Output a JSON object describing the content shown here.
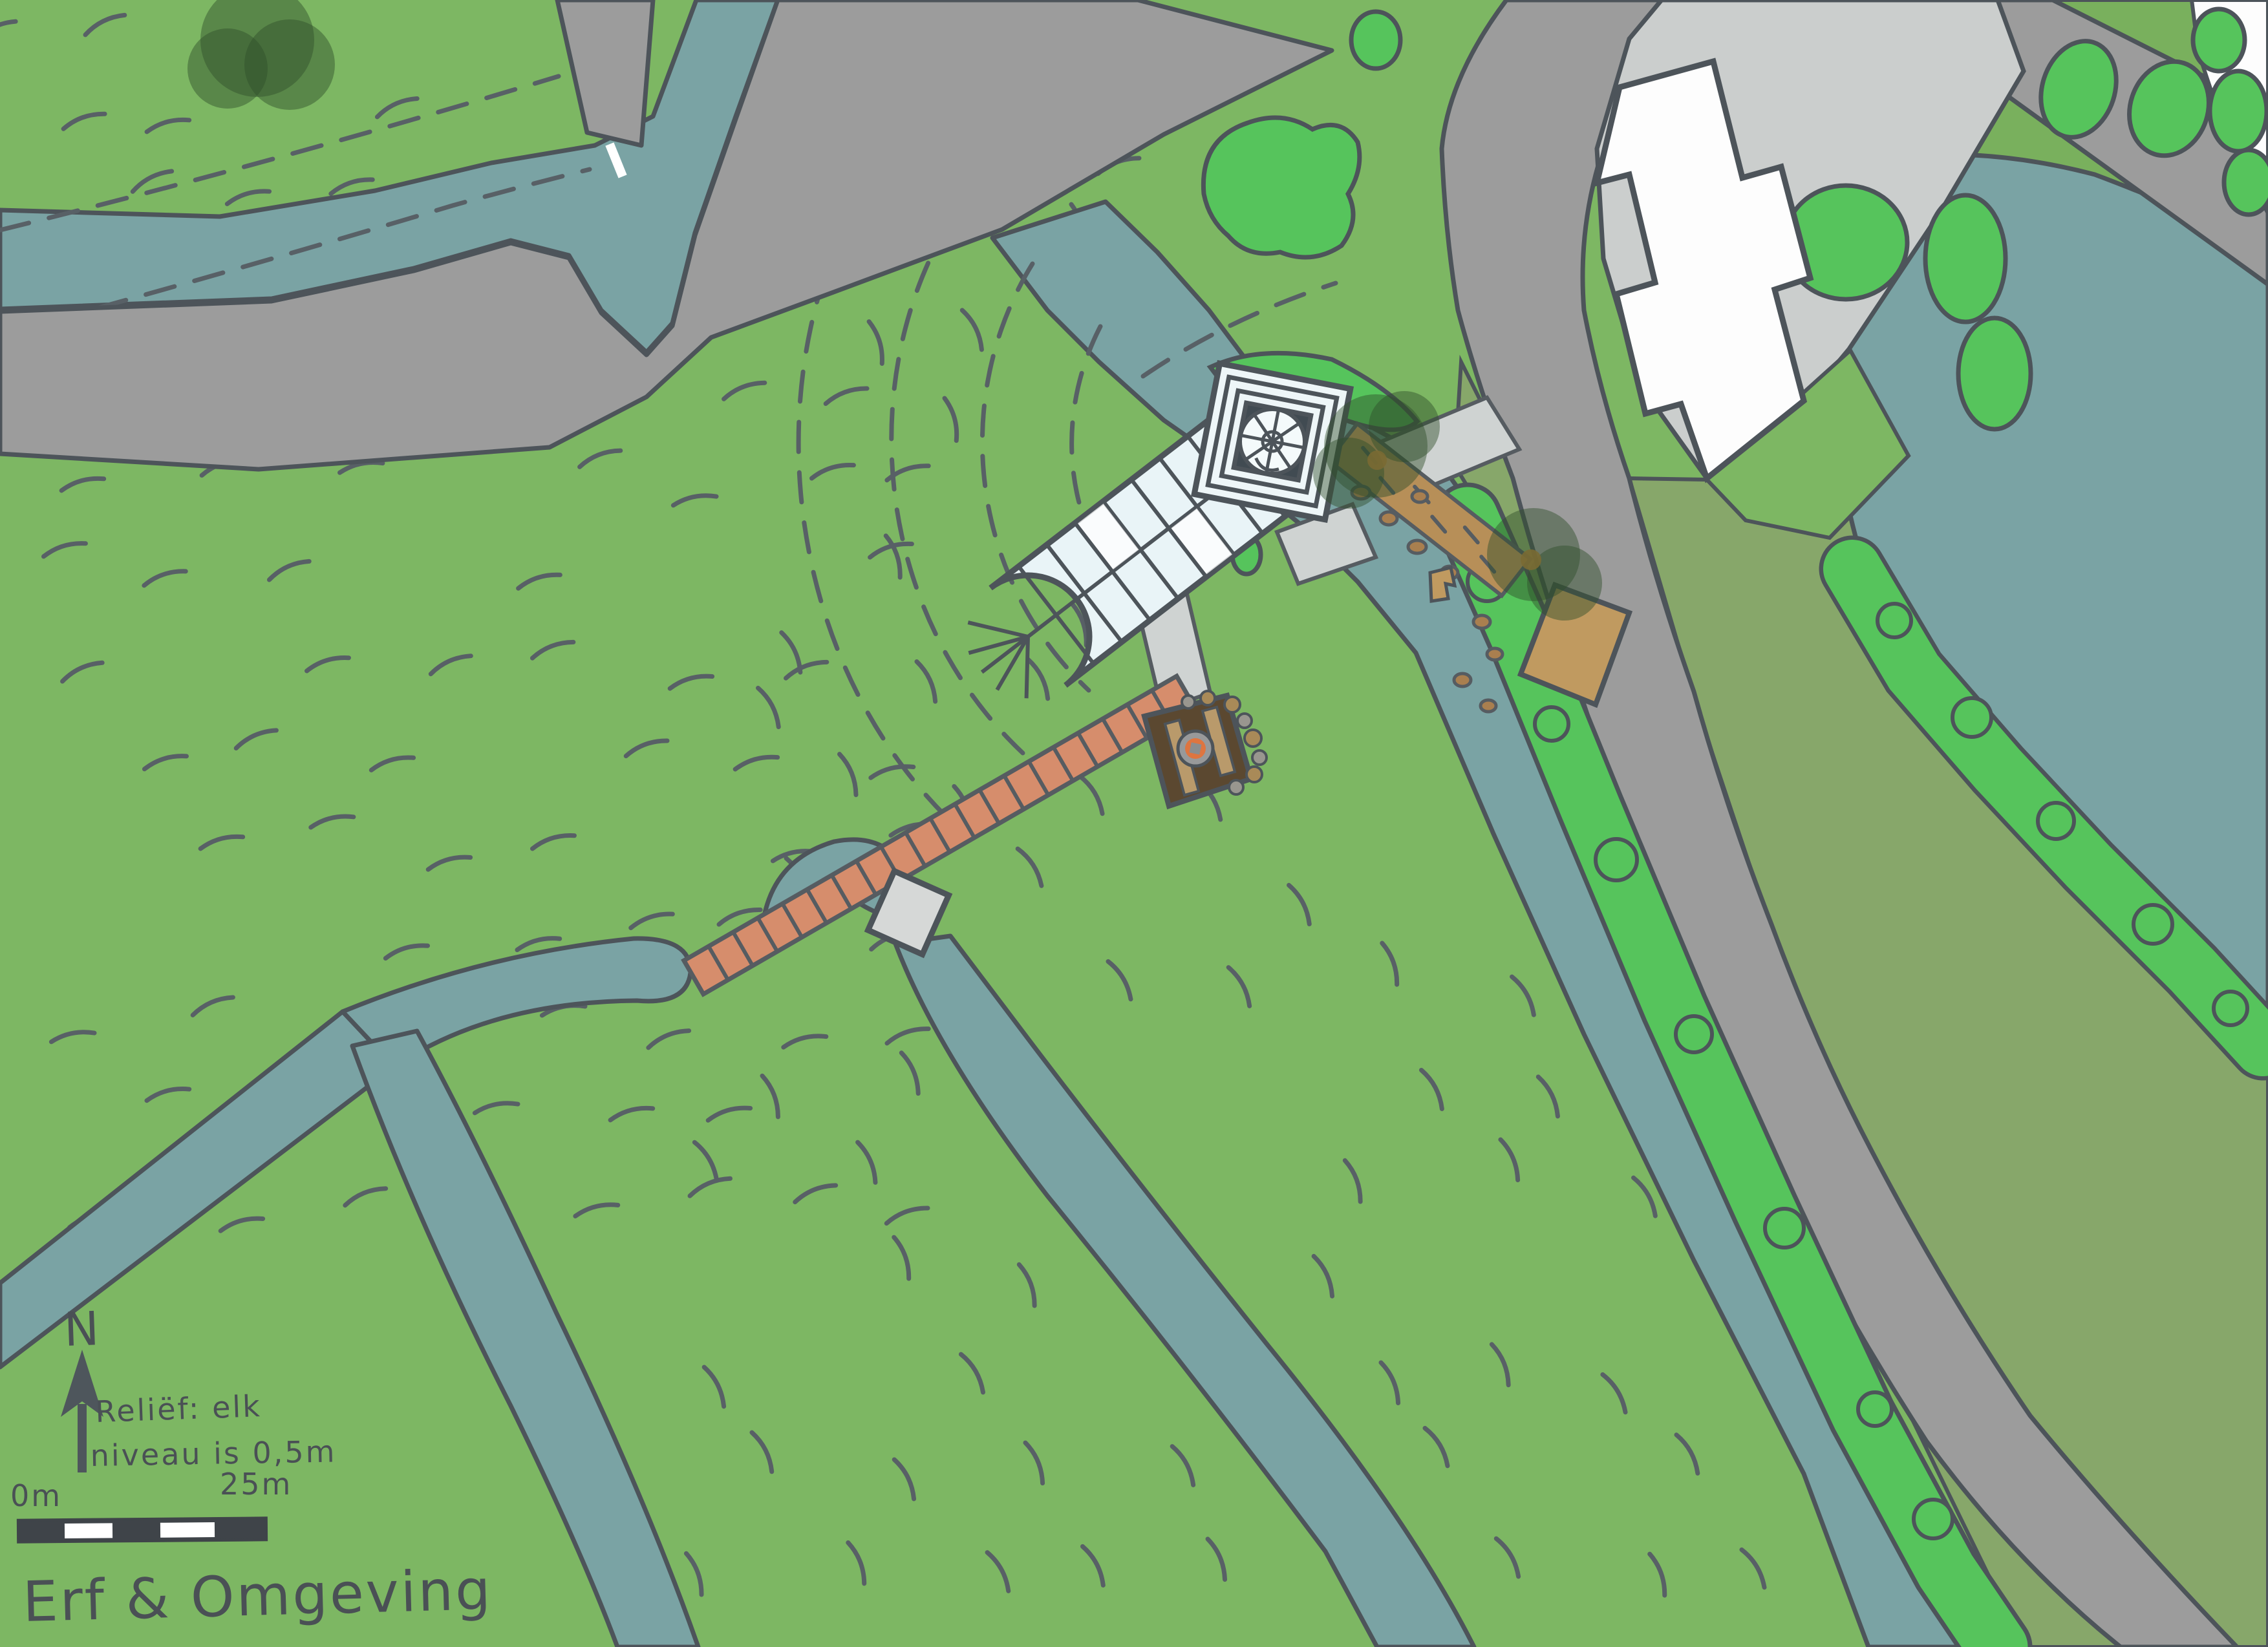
{
  "map": {
    "title": "Erf & Omgeving",
    "north_label": "N",
    "relief_note_line1": "Reliëf: elk",
    "relief_note_line2": "niveau is 0,5m",
    "scale": {
      "start_label": "0m",
      "end_label": "25m"
    },
    "colors": {
      "field_green": "#7db763",
      "olive_band": "#87a76a",
      "bright_vegetation": "#56c45c",
      "water_teal": "#7aa3a4",
      "road_gray": "#9c9c9c",
      "paved_light_gray": "#cbcecd",
      "building_white": "#fdfdfd",
      "glass_pale_blue": "#e9f4f7",
      "brick_path": "#d68d6c",
      "wood_deck": "#5b4830",
      "tan_path": "#b78f58",
      "tree_dark_green": "#3a5a33",
      "outline": "#4d545a",
      "ink": "#4a5055"
    },
    "features": {
      "greenhouse": "glasshouse with tower",
      "tower": "square tower with dome stair",
      "deck": "wooden terrace with fire pit",
      "brick_path": "brick garden path",
      "boardwalk": "stepping stone walkway",
      "pond": "large pond",
      "ditches": "field drainage ditches",
      "house": "white farmhouse",
      "bridge": "small dam bridge"
    }
  }
}
